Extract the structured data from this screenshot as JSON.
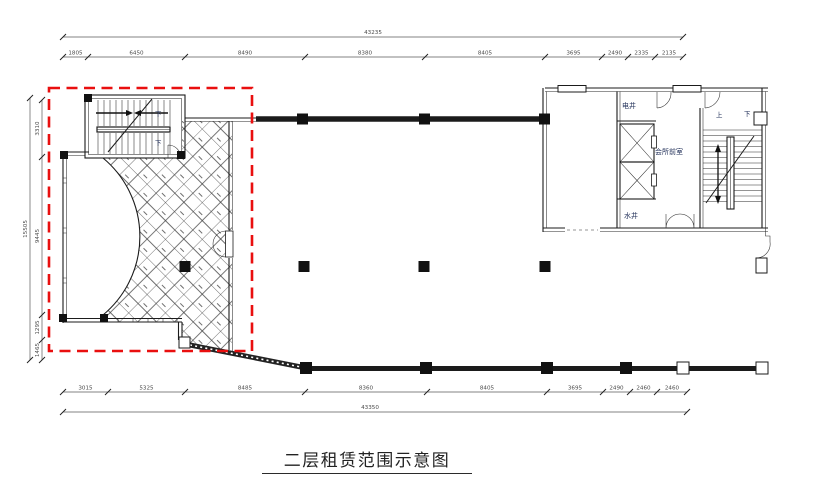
{
  "title": {
    "text": "二层租赁范围示意图"
  },
  "colors": {
    "highlight_red": "#e90f0f",
    "line": "#1b1b1b",
    "dim_text": "#4a4a4a",
    "room_text": "#223059"
  },
  "labels": {
    "elec_shaft": "电井",
    "water_shaft": "水井",
    "club_anteroom": "会所前室",
    "up": "上",
    "down": "下"
  },
  "dims": {
    "top_total": "43235",
    "top_segments": [
      "1805",
      "6450",
      "8490",
      "8380",
      "8405",
      "3695",
      "2490",
      "2335",
      "2135"
    ],
    "bottom_segments": [
      "3015",
      "5325",
      "8485",
      "8360",
      "8405",
      "3695",
      "2490",
      "2460",
      "2460"
    ],
    "bottom_total": "43350",
    "left_total": "15505",
    "left_segments": [
      "3310",
      "9445",
      "1295",
      "1465"
    ]
  }
}
